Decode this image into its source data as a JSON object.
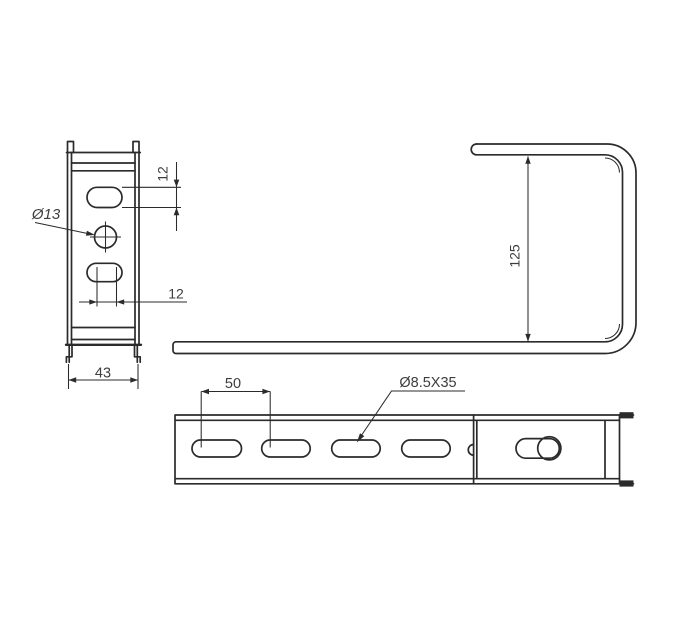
{
  "colors": {
    "background": "#ffffff",
    "line": "#2b2b2b",
    "text": "#3d3d3d"
  },
  "drawing": {
    "type": "technical-drawing",
    "views": [
      "front",
      "side",
      "top"
    ]
  },
  "front_view": {
    "label_slot_height": "12",
    "label_hole_dia": "Ø13",
    "label_slot_width": "12",
    "label_overall_width": "43"
  },
  "side_view": {
    "label_height": "125"
  },
  "top_view": {
    "label_slot_pitch": "50",
    "label_slot_size": "Ø8.5X35"
  }
}
